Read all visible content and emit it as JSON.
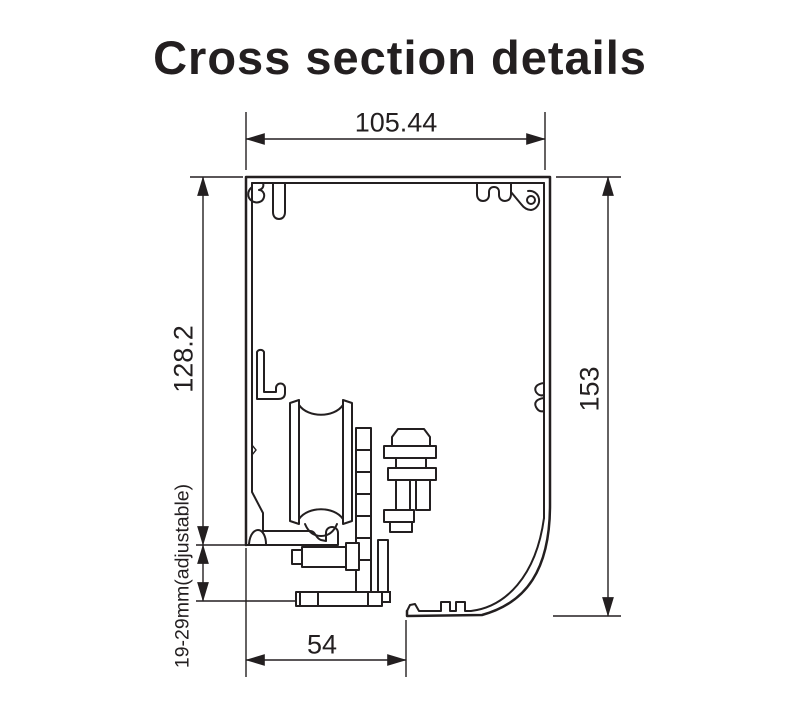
{
  "title": "Cross section details",
  "drawing": {
    "description": "cross-section line drawing of an aluminium track profile with internal roller carriage",
    "line_color": "#231f20",
    "background_color": "#ffffff",
    "dimensions": {
      "top_width": "105.44",
      "left_height": "128.2",
      "right_height": "153",
      "bottom_width": "54",
      "hanger_adjustment": "19-29mm(adjustable)"
    }
  }
}
